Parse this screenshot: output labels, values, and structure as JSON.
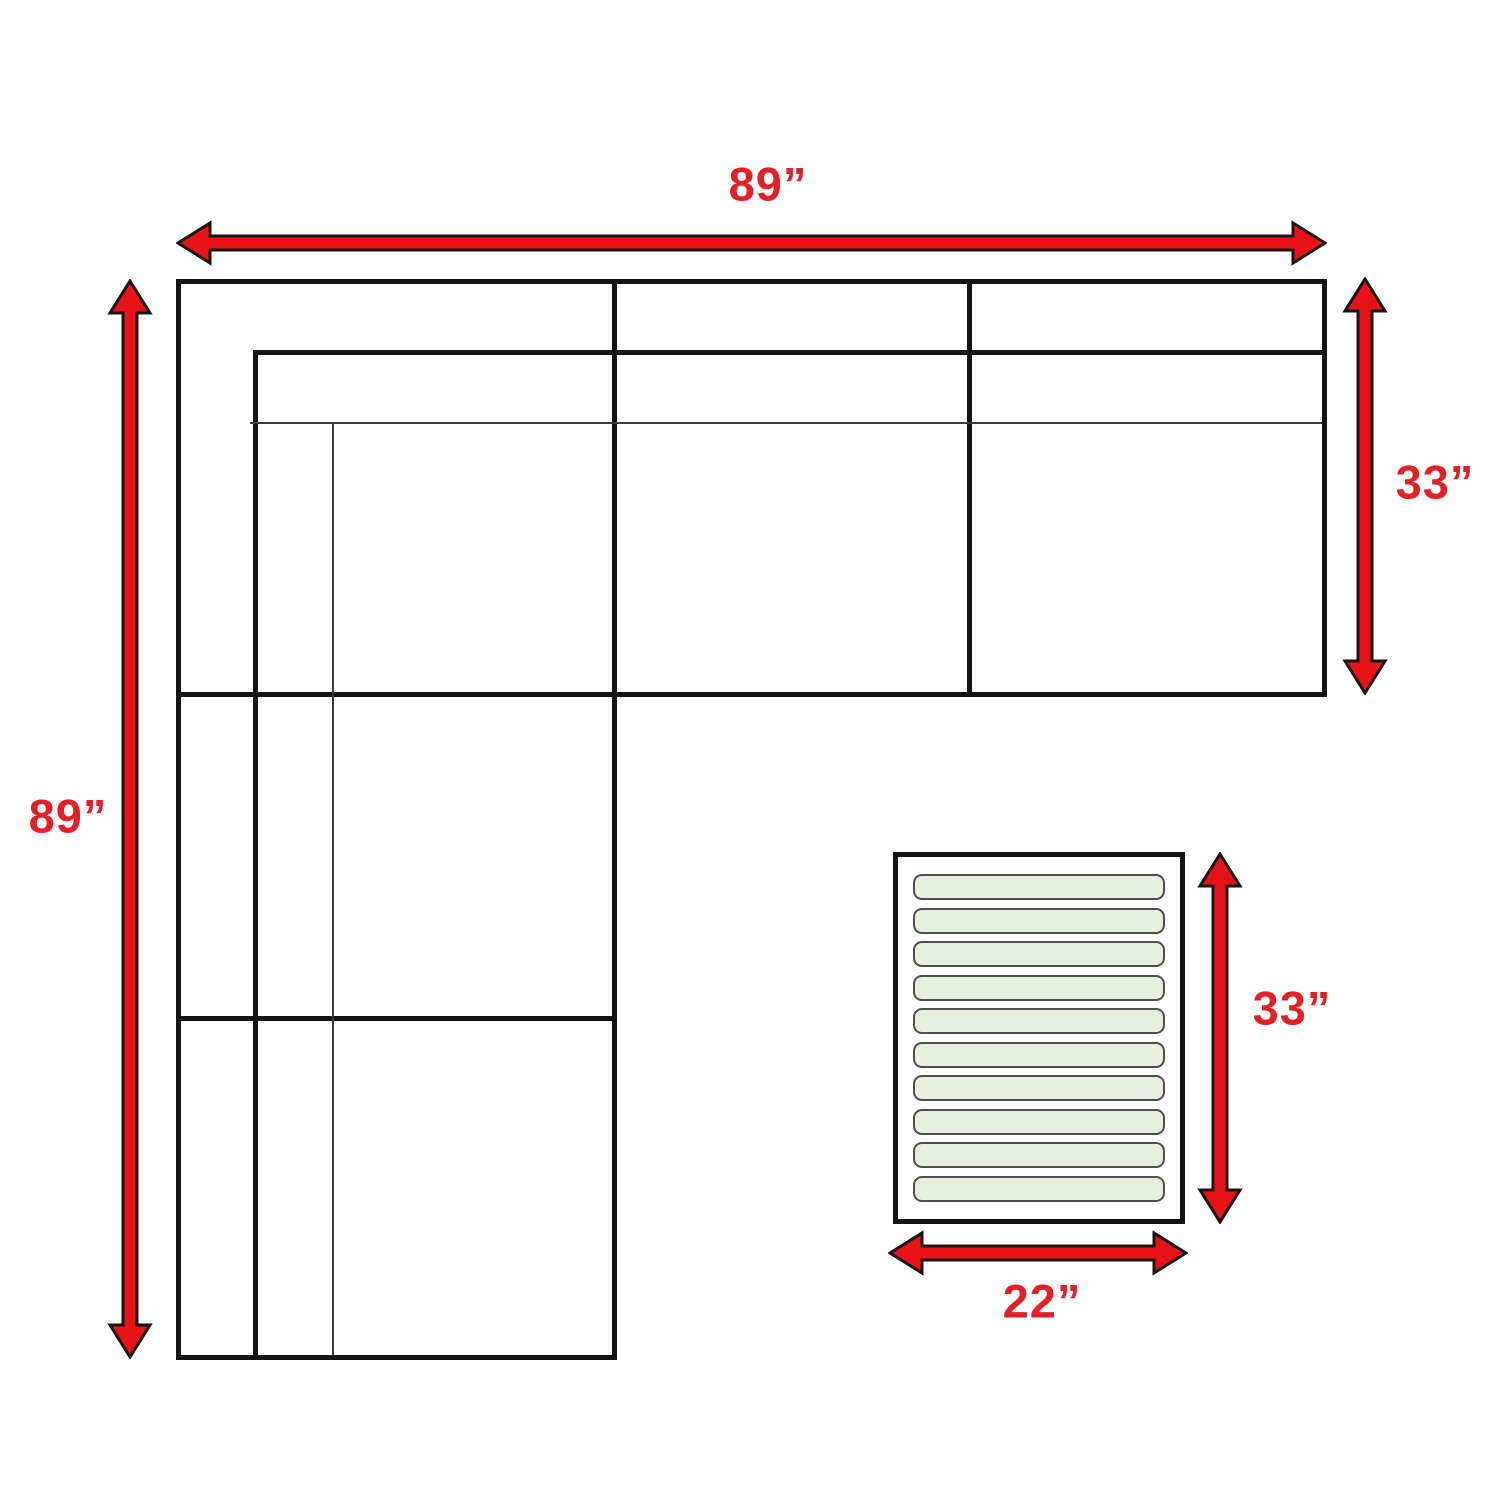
{
  "diagram": {
    "type": "sectional-sofa-dimension-diagram",
    "labels": {
      "sofa_width": "89”",
      "sofa_height": "89”",
      "sofa_depth": "33”",
      "ottoman_height": "33”",
      "ottoman_width": "22”"
    },
    "colors": {
      "arrow_red": "#e81219",
      "label_red": "#e32028",
      "line_black": "#141414",
      "thin_line": "#3c3c3c",
      "slat_fill": "#e7efe0",
      "slat_border": "#4f4f4f",
      "background": "#ffffff"
    },
    "ottoman": {
      "slat_count": 10
    }
  }
}
